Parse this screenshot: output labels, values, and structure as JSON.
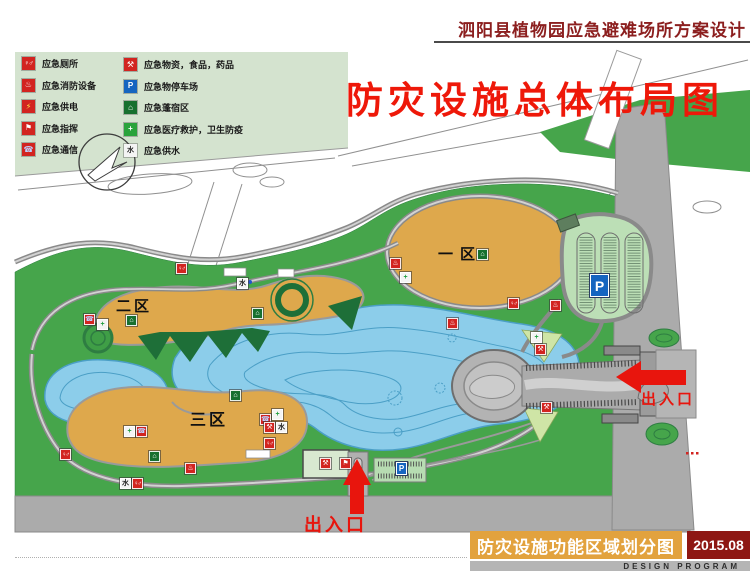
{
  "header": {
    "title": "泗阳县植物园应急避难场所方案设计"
  },
  "map": {
    "big_title": "防灾设施总体布局图",
    "zones": [
      {
        "label": "一区"
      },
      {
        "label": "二区"
      },
      {
        "label": "三区"
      }
    ],
    "entrances": [
      {
        "label": "出入口"
      },
      {
        "label": "出入口"
      }
    ],
    "parking_label": "P",
    "icons": [
      {
        "type": "toilet",
        "x": 176,
        "y": 263
      },
      {
        "type": "water",
        "x": 237,
        "y": 278
      },
      {
        "type": "phone",
        "x": 84,
        "y": 314
      },
      {
        "type": "medical",
        "x": 97,
        "y": 319
      },
      {
        "type": "tent",
        "x": 126,
        "y": 315
      },
      {
        "type": "tent",
        "x": 252,
        "y": 308
      },
      {
        "type": "fire",
        "x": 390,
        "y": 258
      },
      {
        "type": "medical",
        "x": 400,
        "y": 272
      },
      {
        "type": "tent",
        "x": 477,
        "y": 249
      },
      {
        "type": "toilet",
        "x": 508,
        "y": 298
      },
      {
        "type": "fire",
        "x": 447,
        "y": 318
      },
      {
        "type": "fire",
        "x": 550,
        "y": 300
      },
      {
        "type": "medical",
        "x": 531,
        "y": 332
      },
      {
        "type": "supplies",
        "x": 535,
        "y": 344
      },
      {
        "type": "supplies",
        "x": 541,
        "y": 402
      },
      {
        "type": "medical",
        "x": 124,
        "y": 426
      },
      {
        "type": "phone",
        "x": 136,
        "y": 426
      },
      {
        "type": "tent",
        "x": 230,
        "y": 390
      },
      {
        "type": "phone",
        "x": 260,
        "y": 414
      },
      {
        "type": "medical",
        "x": 272,
        "y": 409
      },
      {
        "type": "supplies",
        "x": 264,
        "y": 422
      },
      {
        "type": "water",
        "x": 276,
        "y": 422
      },
      {
        "type": "toilet",
        "x": 264,
        "y": 438
      },
      {
        "type": "tent",
        "x": 149,
        "y": 451
      },
      {
        "type": "toilet",
        "x": 60,
        "y": 449
      },
      {
        "type": "water",
        "x": 120,
        "y": 478
      },
      {
        "type": "toilet",
        "x": 132,
        "y": 478
      },
      {
        "type": "fire",
        "x": 185,
        "y": 463
      },
      {
        "type": "supplies",
        "x": 320,
        "y": 458
      },
      {
        "type": "command",
        "x": 340,
        "y": 458
      }
    ]
  },
  "legend": {
    "columns": [
      {
        "items": [
          {
            "type": "toilet",
            "label": "应急厕所"
          },
          {
            "type": "fire",
            "label": "应急消防设备"
          },
          {
            "type": "power",
            "label": "应急供电"
          },
          {
            "type": "command",
            "label": "应急指挥"
          },
          {
            "type": "phone",
            "label": "应急通信"
          }
        ]
      },
      {
        "items": [
          {
            "type": "supplies",
            "label": "应急物资，食品，药品"
          },
          {
            "type": "parking",
            "label": "应急物停车场"
          },
          {
            "type": "tent",
            "label": "应急蓬宿区"
          },
          {
            "type": "medical",
            "label": "应急医疗救护，卫生防疫"
          },
          {
            "type": "water",
            "label": "应急供水"
          }
        ]
      }
    ]
  },
  "footer": {
    "title": "防灾设施功能区域划分图",
    "date": "2015.08",
    "subtitle": "DESIGN PROGRAM"
  },
  "colors": {
    "accent_red": "#e8150d",
    "title_maroon": "#8c1f1f",
    "park_green": "#46a54b",
    "zone_orange": "#dea84c",
    "lake_blue": "#8ccdea",
    "road_gray": "#ababab",
    "legend_bg": "#d4e3cf",
    "footer_orange": "#e2a23e",
    "footer_red": "#8e1713"
  }
}
